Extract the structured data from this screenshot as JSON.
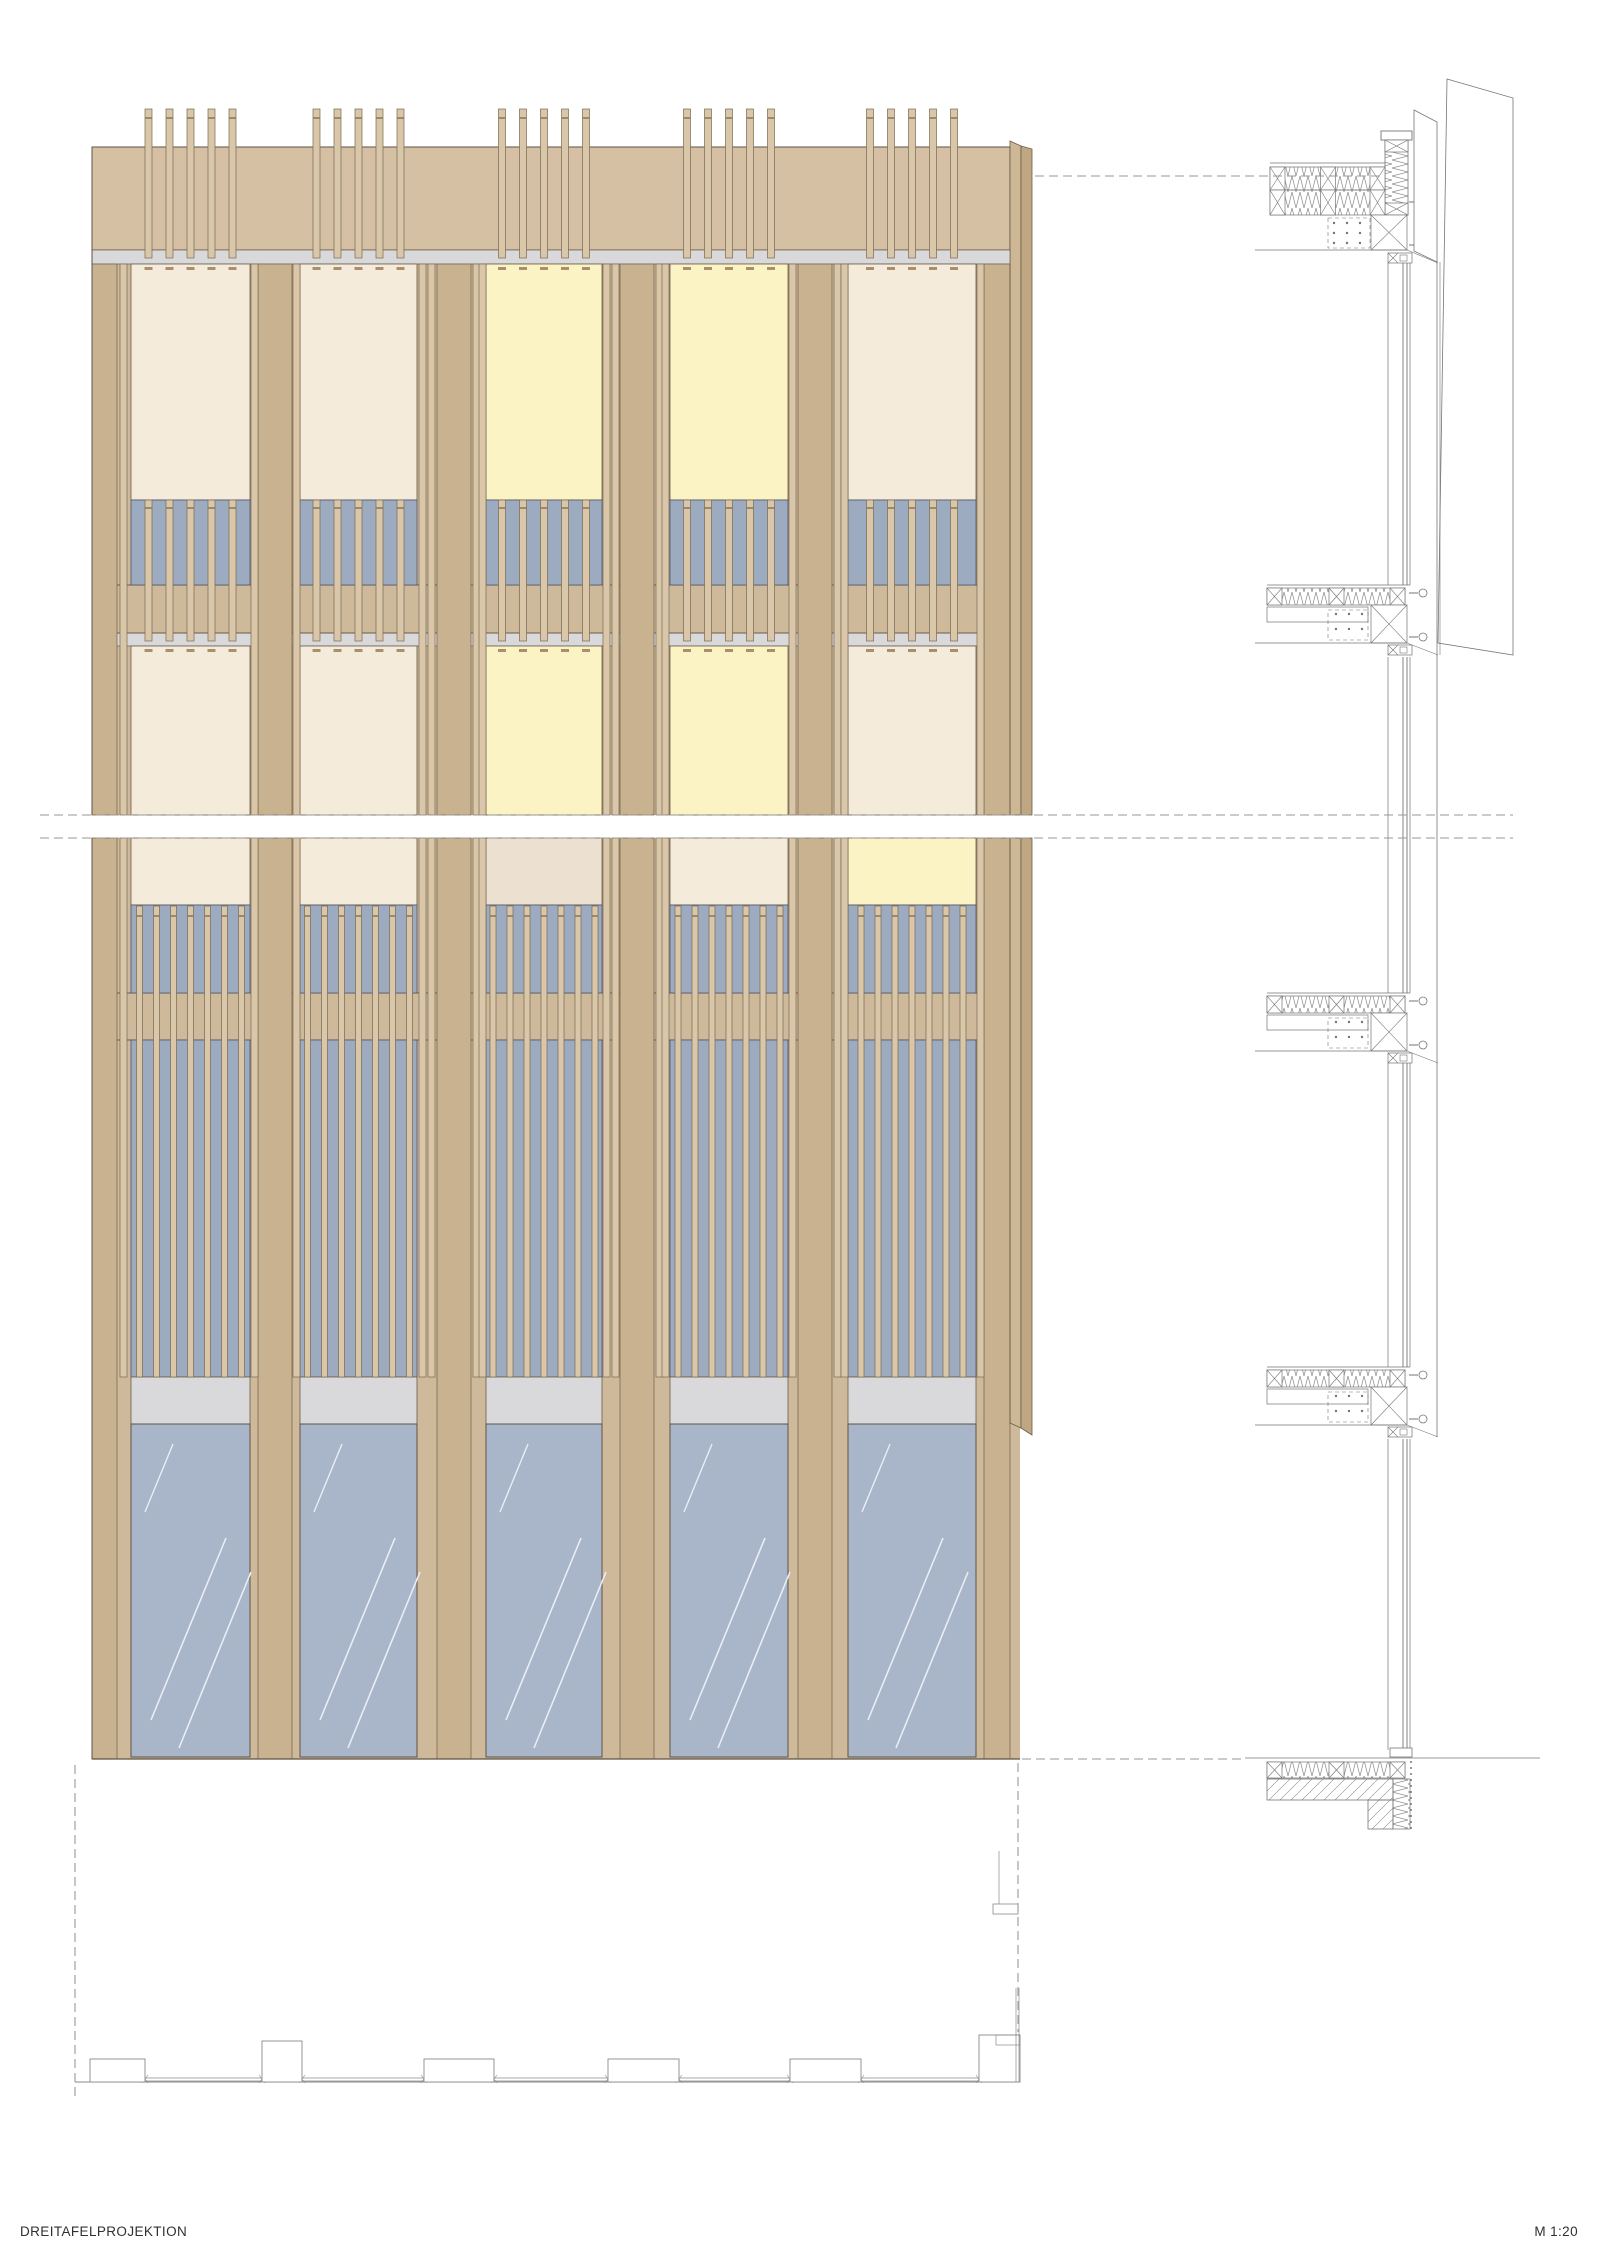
{
  "labels": {
    "title": "DREITAFELPROJEKTION",
    "scale": "M 1:20"
  },
  "canvas": {
    "w": 1600,
    "h": 2262
  },
  "colors": {
    "base": "#cfb99b",
    "band": "#d5c0a3",
    "pillar": "#c9b28f",
    "pillar_line": "#7a6a52",
    "slat": "#dac7aa",
    "slat_line": "#77684f",
    "joint": "#8b7a60",
    "cream": "#f4ebdb",
    "cream2": "#ece0d0",
    "yellow": "#fbf3c3",
    "louvre_blue": "#9dabc1",
    "glass_blue": "#a9b5c8",
    "glass_streak": "#e9eef5",
    "gray_strip": "#d9d9db",
    "fold_in": "#cdb795",
    "fold_out": "#c0a784",
    "dark_line": "#5f5244",
    "panel_line": "#6a5c49",
    "blue_line": "#4f5668",
    "section_line": "#757575",
    "hatch_line": "#8a8a8a",
    "dash_line": "#979797",
    "dash_stub": "#a8906e",
    "plan_line": "#8a8a8a",
    "text": "#303030"
  },
  "facade": {
    "x0": 92,
    "x1": 1010,
    "glass_x1": 1020,
    "fold": {
      "xin": 1021,
      "xout": 1032,
      "ytop_in": 141,
      "ytop_out": 149,
      "ybot_in": 1423,
      "ybot_out": 1435
    },
    "bays": [
      {
        "x0": 131,
        "x1": 250
      },
      {
        "x0": 300,
        "x1": 417
      },
      {
        "x0": 486,
        "x1": 602
      },
      {
        "x0": 670,
        "x1": 788
      },
      {
        "x0": 848,
        "x1": 976
      }
    ],
    "cols": [
      {
        "x0": 92,
        "x1": 131,
        "pillar": [
          92,
          117
        ],
        "slats": [
          120
        ]
      },
      {
        "x0": 250,
        "x1": 300,
        "pillar": [
          258,
          292
        ],
        "slats": [
          251,
          293
        ]
      },
      {
        "x0": 417,
        "x1": 486,
        "pillar": [
          437,
          471
        ],
        "slats": [
          419,
          428,
          473,
          479
        ]
      },
      {
        "x0": 602,
        "x1": 670,
        "pillar": [
          620,
          654
        ],
        "slats": [
          603,
          612,
          656,
          662
        ]
      },
      {
        "x0": 788,
        "x1": 848,
        "pillar": [
          798,
          832
        ],
        "slats": [
          789,
          834,
          841
        ]
      },
      {
        "x0": 976,
        "x1": 1010,
        "pillar": [
          984,
          1010
        ],
        "slats": [
          977
        ]
      }
    ],
    "bands": {
      "slat_top": 109,
      "slat_joint": 118,
      "band": [
        147,
        250
      ],
      "gray1": [
        250,
        264
      ],
      "f3win": [
        264,
        500
      ],
      "f3lou": [
        500,
        585
      ],
      "sp1": [
        585,
        633
      ],
      "gray2": [
        633,
        646
      ],
      "f2win": [
        646,
        815
      ],
      "brk": [
        815,
        838
      ],
      "f2bwin": [
        838,
        905
      ],
      "f2blou": [
        905,
        993
      ],
      "sp2": [
        993,
        1040
      ],
      "tall": [
        1040,
        1377
      ],
      "transom": [
        1377,
        1424
      ],
      "glass": [
        1424,
        1759
      ],
      "lou_joint3": 508,
      "lou_jointB": 916,
      "dash1": 267,
      "dash2": 649
    },
    "floor_colors": {
      "f3": [
        "cream",
        "cream",
        "yellow",
        "yellow",
        "cream"
      ],
      "f2": [
        "cream",
        "cream",
        "yellow",
        "yellow",
        "cream"
      ],
      "f2b": [
        "cream",
        "cream",
        "cream2",
        "cream",
        "yellow"
      ]
    },
    "slat_sets": {
      "top": {
        "count": 5,
        "pitch": 21,
        "w": 7,
        "y": [
          109,
          258
        ]
      },
      "f3": {
        "count": 5,
        "pitch": 21,
        "w": 7,
        "y": [
          500,
          641
        ]
      },
      "low": {
        "count": 7,
        "pitch": 17,
        "w": 6,
        "y": [
          906,
          1377
        ]
      }
    }
  },
  "section": {
    "x": {
      "slab_l": 1267,
      "slab_r": 1385,
      "plate_r": 1368,
      "xbox_l": 1371,
      "xbox_r": 1407,
      "box_l": 1388,
      "box_r": 1410,
      "win": [
        1388,
        1403,
        1407,
        1410
      ],
      "fin_l": 1414,
      "fin_r": 1437,
      "bolt": 1423,
      "panel_r": 1513,
      "ceil_l": 1255
    },
    "roof": {
      "cap": [
        131,
        140
      ],
      "column": [
        140,
        215
      ],
      "slab_lines": [
        163,
        167
      ],
      "strip1": [
        167,
        190
      ],
      "strip2": [
        190,
        215
      ],
      "xbox": [
        215,
        250
      ],
      "ceil": 250,
      "smallbox": [
        253,
        263
      ],
      "bolts": [
        202,
        245
      ]
    },
    "details": [
      {
        "y0": 585
      },
      {
        "y0": 993
      },
      {
        "y0": 1367
      }
    ],
    "finA": [
      [
        1414,
        110
      ],
      [
        1437,
        122
      ],
      [
        1437,
        262
      ],
      [
        1414,
        251
      ]
    ],
    "panel2": [
      [
        1447,
        79
      ],
      [
        1513,
        98
      ],
      [
        1513,
        655
      ],
      [
        1438,
        643
      ]
    ],
    "fin_edge": {
      "x": 1437,
      "y": [
        262,
        1437
      ]
    },
    "fin_edge2": {
      "x": 1440,
      "y": [
        262,
        655
      ]
    },
    "window_segments": [
      [
        263,
        585
      ],
      [
        657,
        993
      ],
      [
        1063,
        1367
      ],
      [
        1439,
        1750
      ]
    ],
    "ground": {
      "line_y": 1758,
      "line_x": [
        1245,
        1540
      ],
      "insul": [
        1762,
        1778
      ],
      "slab": [
        1267,
        1393,
        1779,
        1800
      ],
      "step": [
        1368,
        1393,
        1800,
        1829
      ],
      "vinsul": [
        1393,
        1410,
        1779,
        1829
      ],
      "sill": [
        1390,
        1412,
        1748,
        1757
      ]
    }
  },
  "plan": {
    "wall_y": 2082,
    "wall_x": [
      75,
      1020
    ],
    "glaze_y": [
      2078,
      2081
    ],
    "boxes": [
      {
        "x0": 90,
        "x1": 145,
        "y0": 2059
      },
      {
        "x0": 262,
        "x1": 302,
        "y0": 2041
      },
      {
        "x0": 424,
        "x1": 494,
        "y0": 2059
      },
      {
        "x0": 608,
        "x1": 679,
        "y0": 2059
      },
      {
        "x0": 790,
        "x1": 861,
        "y0": 2059
      },
      {
        "x0": 979,
        "x1": 1020,
        "y0": 2035
      }
    ],
    "corner": {
      "line_x": 999,
      "line_y": [
        1851,
        1904
      ],
      "box": [
        993,
        1904,
        25,
        10
      ],
      "vlines_x": [
        1016,
        1019
      ],
      "vlines_y": [
        1988,
        2082
      ]
    }
  },
  "dashed": [
    {
      "x1": 40,
      "y1": 815,
      "x2": 1513,
      "y2": 815
    },
    {
      "x1": 40,
      "y1": 838,
      "x2": 1513,
      "y2": 838
    },
    {
      "x1": 1035,
      "y1": 176,
      "x2": 1383,
      "y2": 176
    },
    {
      "x1": 1022,
      "y1": 1759,
      "x2": 1243,
      "y2": 1759
    },
    {
      "x1": 75,
      "y1": 1765,
      "x2": 75,
      "y2": 2096
    },
    {
      "x1": 1018,
      "y1": 1763,
      "x2": 1018,
      "y2": 2032
    }
  ]
}
